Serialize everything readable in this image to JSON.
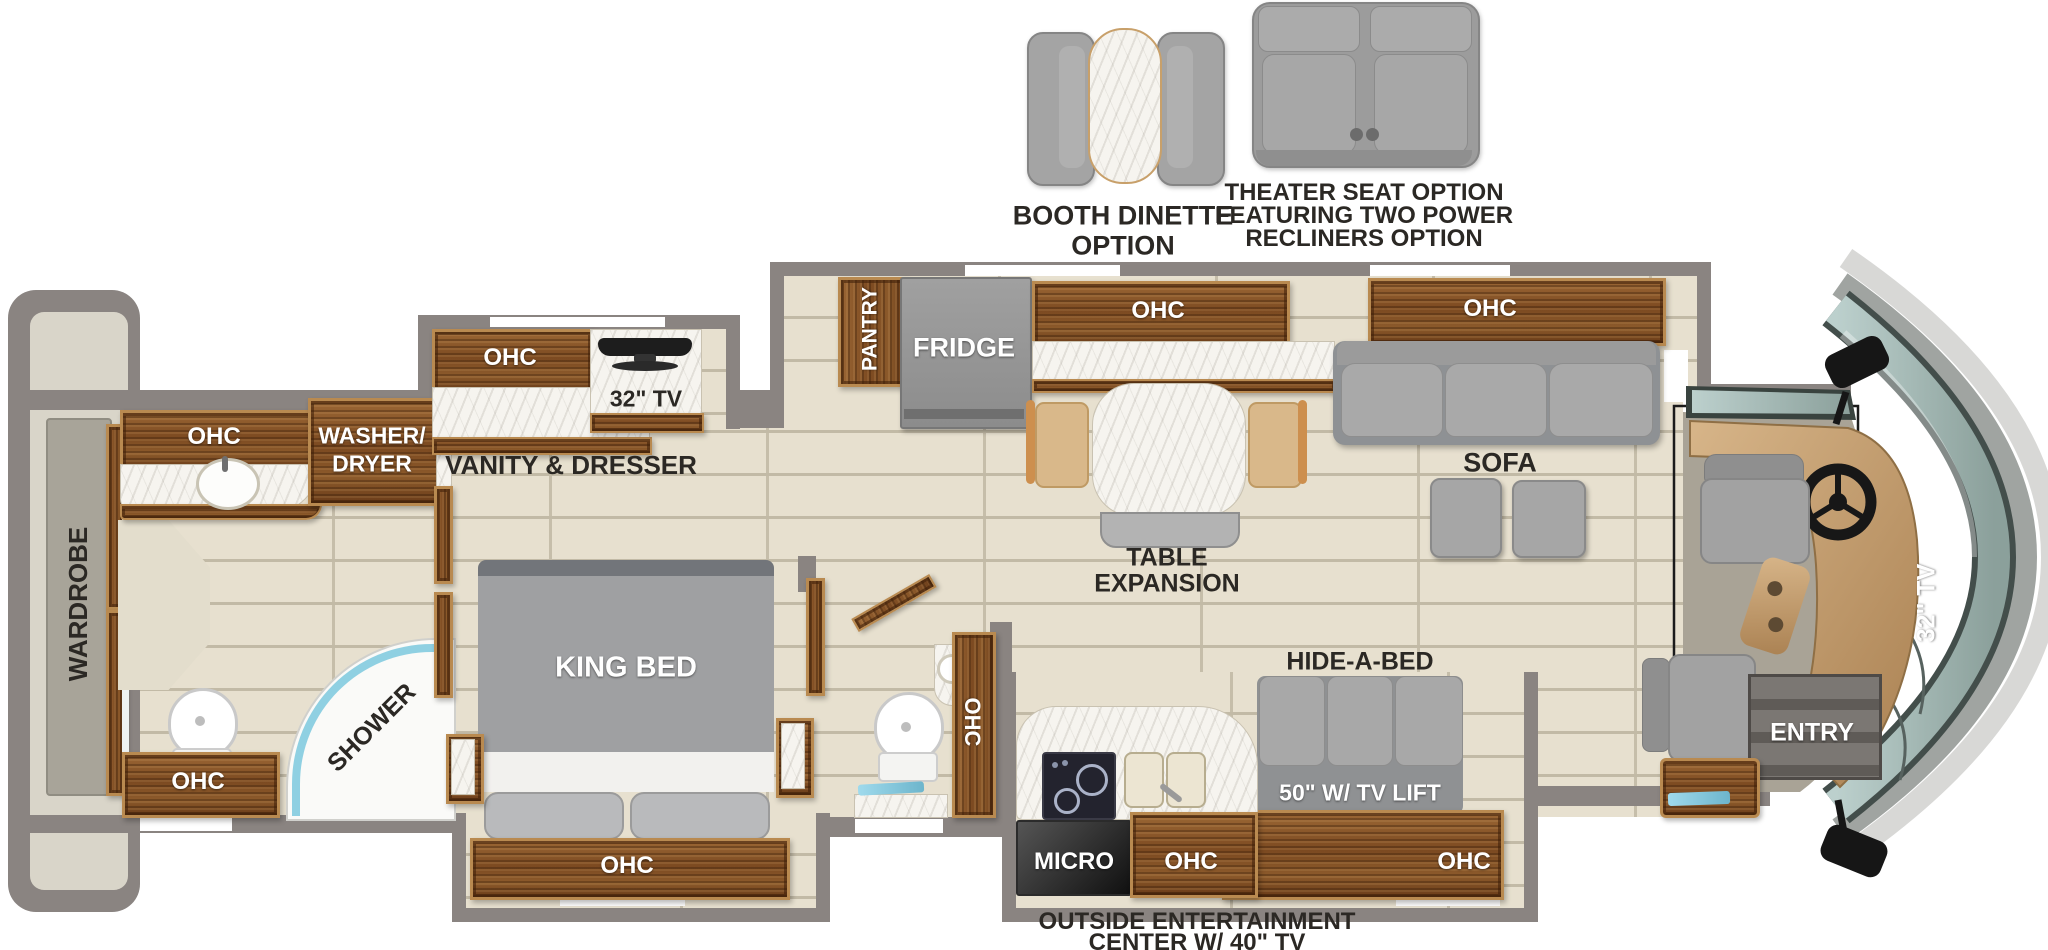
{
  "options": {
    "booth_dinette": {
      "line1": "BOOTH DINETTE",
      "line2": "OPTION"
    },
    "theater_seat": {
      "line1": "THEATER SEAT OPTION",
      "line2": "FEATURING TWO POWER",
      "line3": "RECLINERS OPTION"
    }
  },
  "coach": {
    "rear": {
      "wardrobe_label": "WARDROBE"
    },
    "rear_bath": {
      "ohc_top": "OHC",
      "washer_line1": "WASHER/",
      "washer_line2": "DRYER",
      "ohc_bottom": "OHC",
      "shower_label": "SHOWER"
    },
    "bedroom": {
      "ohc_vanity": "OHC",
      "tv_label": "32\" TV",
      "vanity_label": "VANITY & DRESSER",
      "bed_label": "KING BED",
      "ohc_slide": "OHC"
    },
    "half_bath": {
      "ohc_label": "OHC"
    },
    "kitchen": {
      "pantry_label": "PANTRY",
      "fridge_label": "FRIDGE",
      "ohc_label": "OHC",
      "table_line1": "TABLE",
      "table_line2": "EXPANSION",
      "micro_label": "MICRO",
      "ohc_bottom_label": "OHC"
    },
    "living": {
      "ohc_sofa": "OHC",
      "sofa_label": "SOFA",
      "hide_a_bed_label": "HIDE-A-BED",
      "tv_lift_label": "50\" W/ TV LIFT",
      "ohc_tv_cabinet": "OHC"
    },
    "front": {
      "tv_label": "32\" TV",
      "entry_label": "ENTRY"
    },
    "exterior": {
      "line1": "OUTSIDE ENTERTAINMENT",
      "line2": "CENTER W/ 40\" TV"
    }
  },
  "palette": {
    "wall": "#8a8481",
    "floor_tile": "#e7e0cf",
    "wood": "#7c4a21",
    "marble": "#f6f4ef",
    "furniture_gray": "#a4a4a4",
    "cab_floor": "#a9a396",
    "dash_tan": "#c9a878",
    "windshield": "#aabbb6",
    "glass_accent": "#86cbdf",
    "text_dark": "#2b2824"
  }
}
